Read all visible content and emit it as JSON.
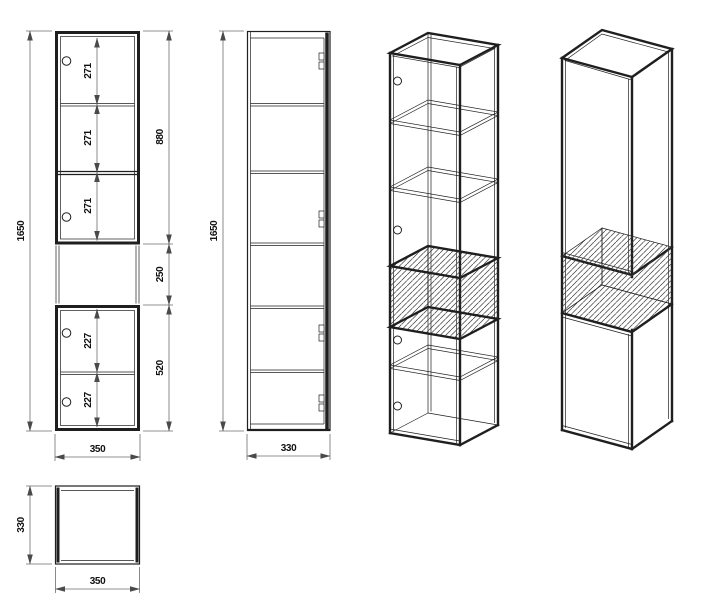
{
  "colors": {
    "line": "#1f1f1f",
    "dimension": "#6e6e6e",
    "text": "#111111",
    "background": "#ffffff"
  },
  "dims": {
    "front_height": "1650",
    "front_width": "350",
    "front_top_section": "880",
    "front_shelf_1": "271",
    "front_shelf_2": "271",
    "front_shelf_3": "271",
    "front_niche": "250",
    "front_bottom_section": "520",
    "front_door_1": "227",
    "front_door_2": "227",
    "side_height": "1650",
    "side_depth": "330",
    "top_depth": "330",
    "top_width": "350"
  }
}
